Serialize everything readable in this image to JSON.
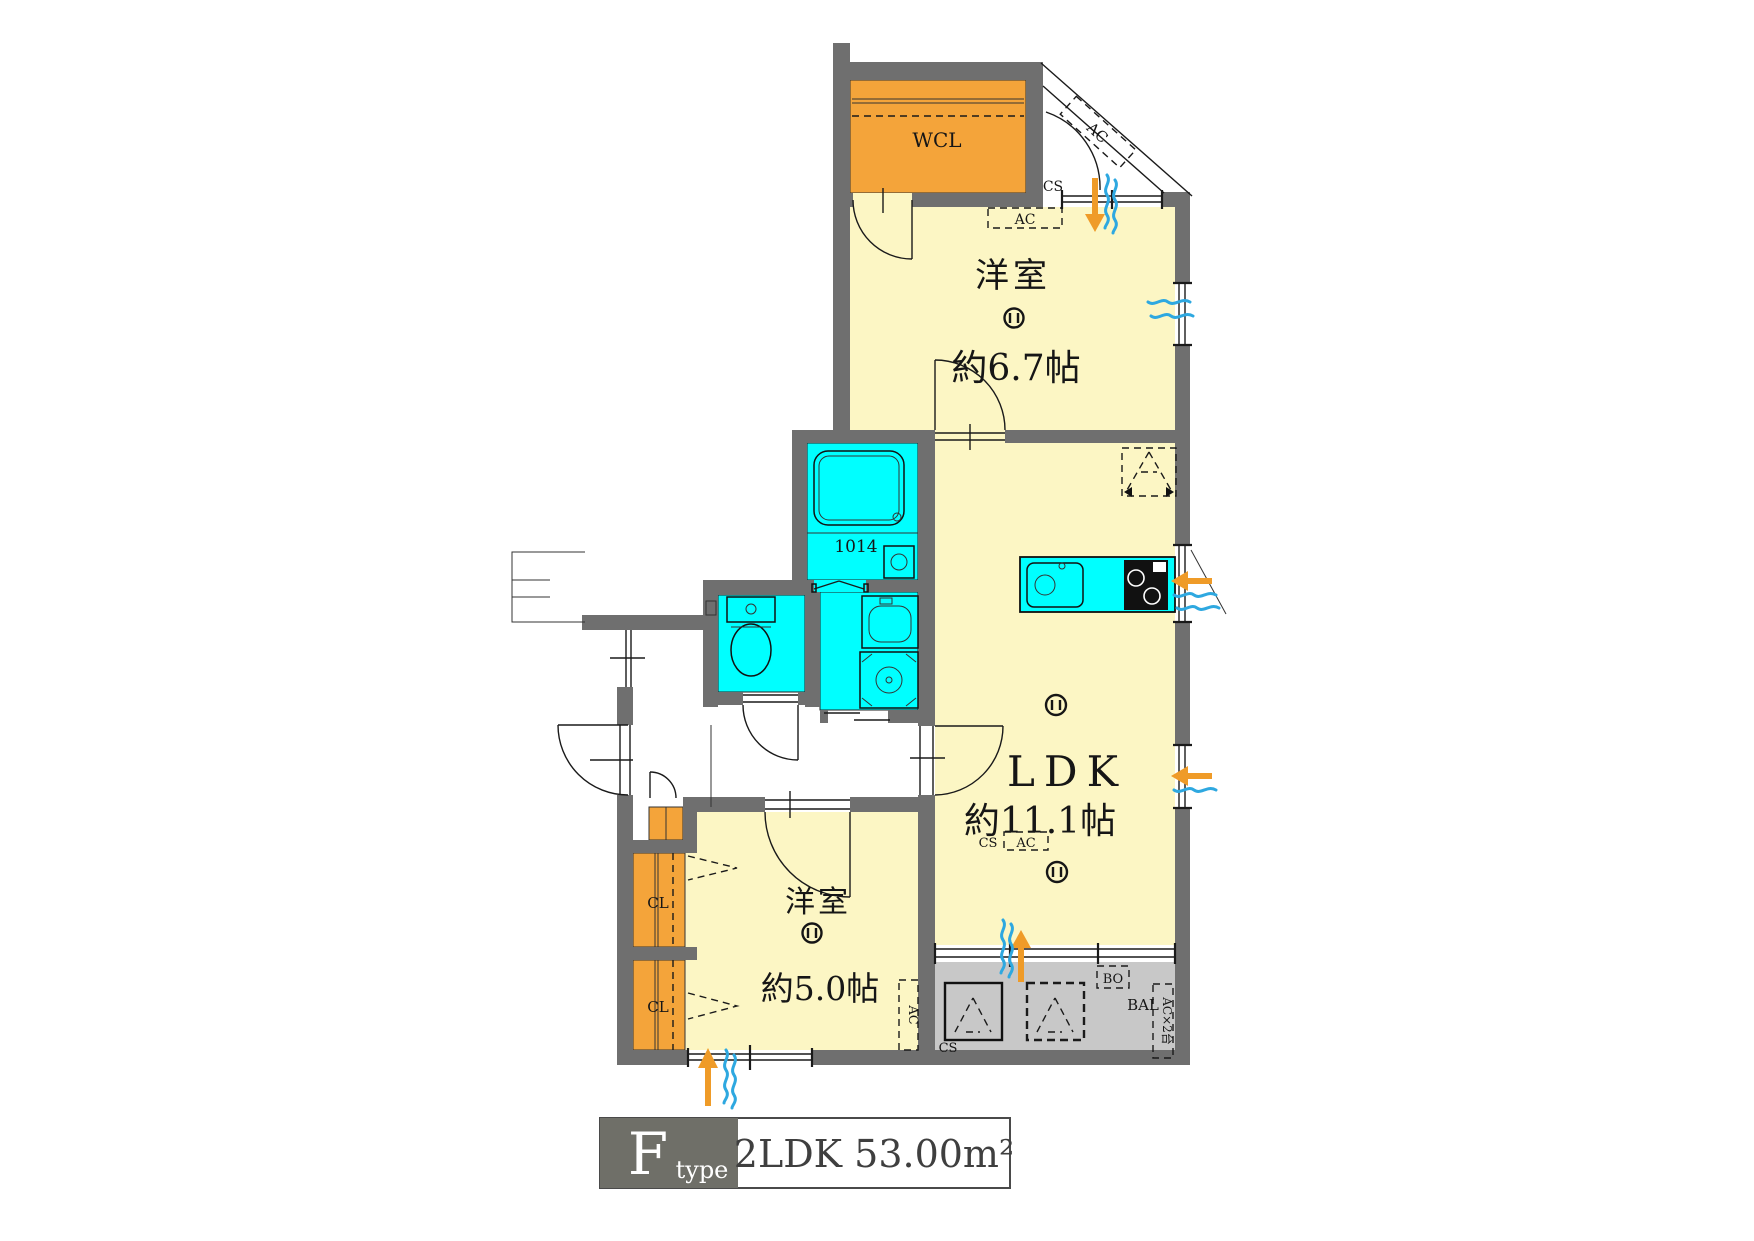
{
  "colors": {
    "wall": "#6f6f6f",
    "room_floor": "#fcf6c4",
    "wet_area": "#00ffff",
    "storage": "#f4a43a",
    "balcony": "#c8c8c8",
    "airflow_arrow": "#ef9b28",
    "airflow_wave": "#2ea8e0",
    "title_box": "#6f6f68"
  },
  "plan": {
    "rooms": {
      "wcl": {
        "label": "WCL"
      },
      "bedroom1": {
        "label": "洋室",
        "size": "約6.7帖"
      },
      "ldk": {
        "label": "LDK",
        "size": "約11.1帖"
      },
      "bedroom2": {
        "label": "洋室",
        "size": "約5.0帖"
      },
      "bath": {
        "size_label": "1014"
      },
      "closet_upper": {
        "label": "CL"
      },
      "closet_lower": {
        "label": "CL"
      },
      "balcony": {
        "label": "BAL"
      }
    },
    "annotations": {
      "cs_top": "CS",
      "ac_eave": "AC",
      "ac_bedroom1": "AC",
      "cs_ldk": "CS",
      "ac_ldk": "AC",
      "bo": "BO",
      "balcony_ac_count": "AC×2台",
      "ac_bedroom2": "AC",
      "cs_balcony": "CS"
    }
  },
  "title": {
    "letter": "F",
    "suffix": "type",
    "spec": "2LDK  53.00m²"
  }
}
